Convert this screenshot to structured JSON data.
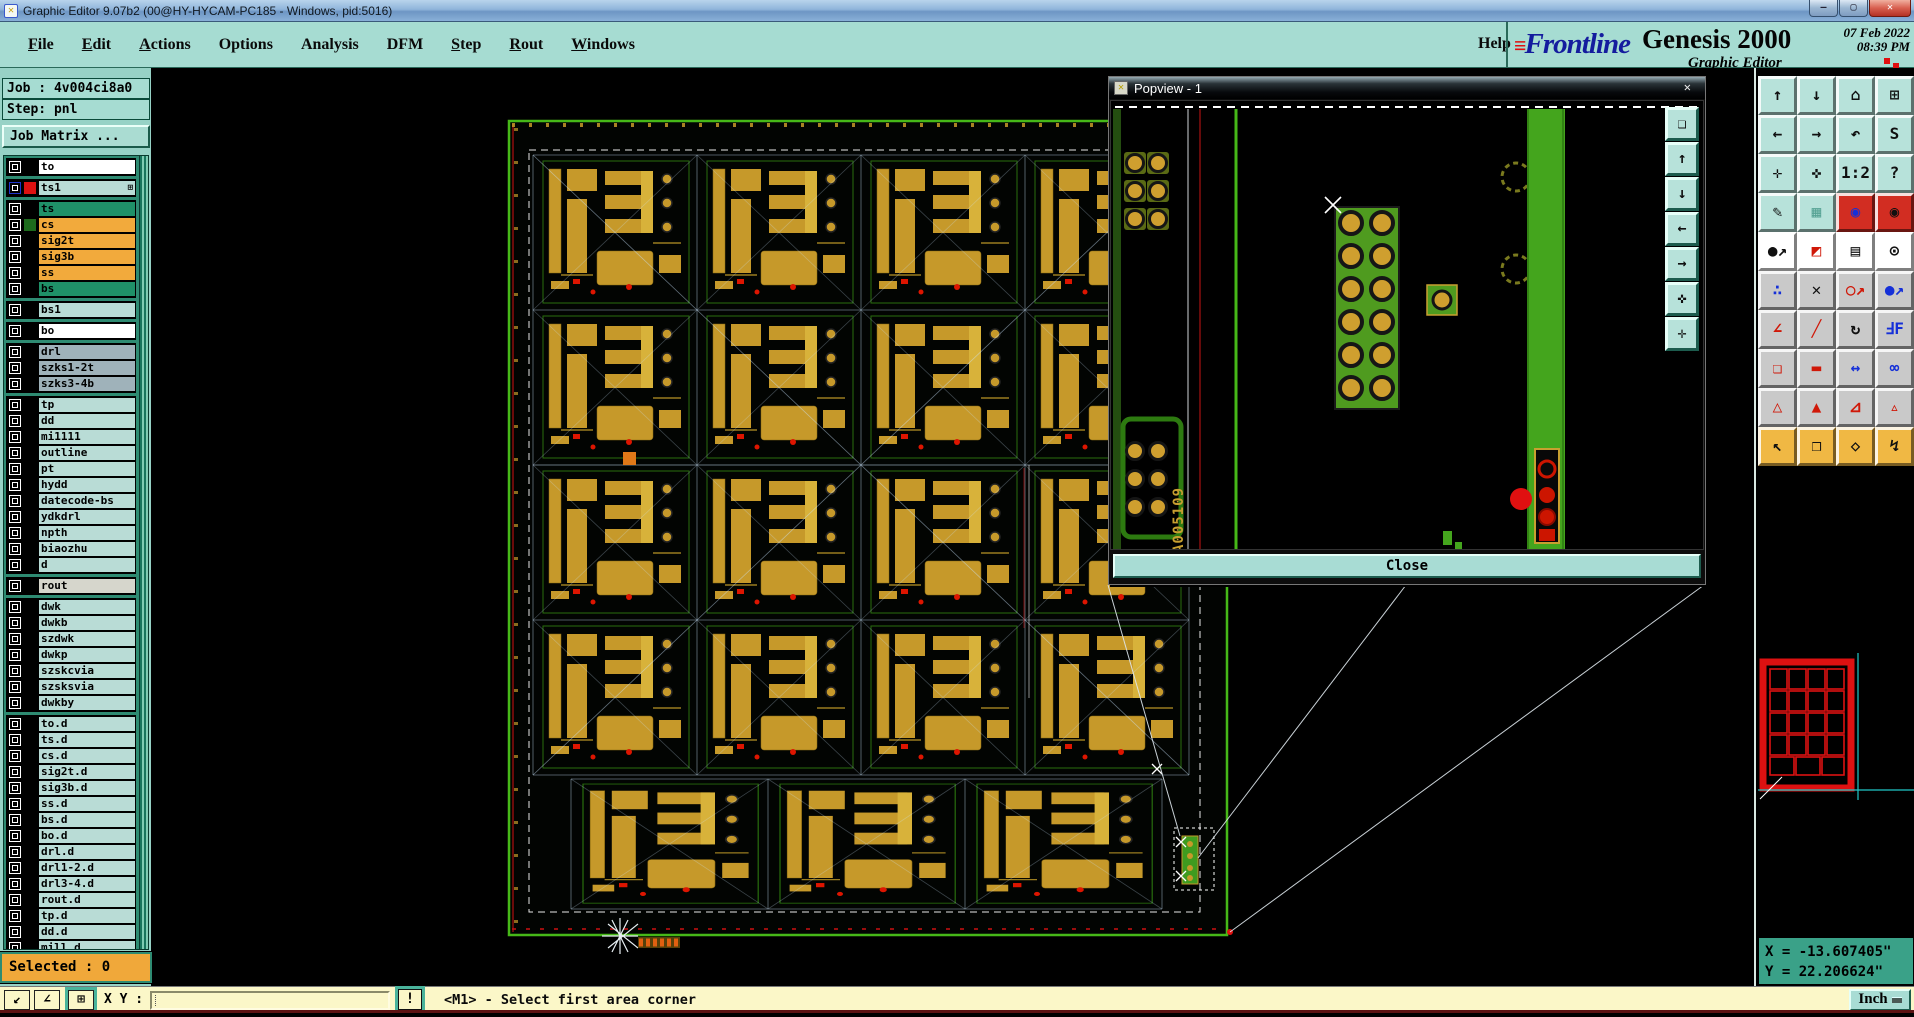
{
  "window": {
    "title": "Graphic Editor 9.07b2 (00@HY-HYCAM-PC185 - Windows, pid:5016)",
    "controls": [
      {
        "name": "minimize-button",
        "glyph": "—"
      },
      {
        "name": "restore-button",
        "glyph": "▢"
      },
      {
        "name": "close-button",
        "glyph": "✕",
        "cls": "winbtn close"
      }
    ]
  },
  "menubar": {
    "items": [
      {
        "label": "File",
        "u": "1"
      },
      {
        "label": "Edit",
        "u": "1"
      },
      {
        "label": "Actions",
        "u": "1"
      },
      {
        "label": "Options",
        "u": "0"
      },
      {
        "label": "Analysis",
        "u": "0"
      },
      {
        "label": "DFM",
        "u": "0"
      },
      {
        "label": "Step",
        "u": "1"
      },
      {
        "label": "Rout",
        "u": "1"
      },
      {
        "label": "Windows",
        "u": "1"
      }
    ],
    "help": "Help"
  },
  "brand": {
    "logo": "Frontline",
    "product": "Genesis 2000",
    "date": "07 Feb 2022",
    "time": "08:39 PM",
    "app": "Graphic Editor"
  },
  "job_panel": {
    "job": "Job : 4v004ci8a0",
    "step": "Step: pnl",
    "matrix": "Job Matrix ..."
  },
  "layers": {
    "g1": [
      {
        "name": "to",
        "bg": "#ffffff"
      }
    ],
    "g2": [
      {
        "name": "ts1",
        "bg": "#b9dcd6",
        "swatch": "#dd1111",
        "cb": "#2036cc",
        "badge": "⊞"
      }
    ],
    "g3": [
      {
        "name": "ts",
        "bg": "#1f9168"
      },
      {
        "name": "cs",
        "bg": "#f2aa3c",
        "swatch": "#1d6b1d"
      },
      {
        "name": "sig2t",
        "bg": "#f2aa3c"
      },
      {
        "name": "sig3b",
        "bg": "#f2aa3c"
      },
      {
        "name": "ss",
        "bg": "#f2aa3c"
      },
      {
        "name": "bs",
        "bg": "#1f9168"
      }
    ],
    "g4": [
      {
        "name": "bs1",
        "bg": "#b9dcd6"
      }
    ],
    "g5": [
      {
        "name": "bo",
        "bg": "#ffffff"
      }
    ],
    "g6": [
      {
        "name": "drl",
        "bg": "#9fb2ba"
      },
      {
        "name": "szks1-2t",
        "bg": "#9fb2ba"
      },
      {
        "name": "szks3-4b",
        "bg": "#9fb2ba"
      }
    ],
    "g7": [
      {
        "name": "tp",
        "bg": "#b9dcd6"
      },
      {
        "name": "dd",
        "bg": "#b9dcd6"
      },
      {
        "name": "mi1111",
        "bg": "#b9dcd6"
      },
      {
        "name": "outline",
        "bg": "#b9dcd6"
      },
      {
        "name": "pt",
        "bg": "#b9dcd6"
      },
      {
        "name": "hydd",
        "bg": "#b9dcd6"
      },
      {
        "name": "datecode-bs",
        "bg": "#b9dcd6"
      },
      {
        "name": "ydkdrl",
        "bg": "#b9dcd6"
      },
      {
        "name": "npth",
        "bg": "#b9dcd6"
      },
      {
        "name": "biaozhu",
        "bg": "#b9dcd6"
      },
      {
        "name": "d",
        "bg": "#b9dcd6"
      }
    ],
    "g8": [
      {
        "name": "rout",
        "bg": "#d6d6cc"
      }
    ],
    "g9": [
      {
        "name": "dwk",
        "bg": "#b9dcd6"
      },
      {
        "name": "dwkb",
        "bg": "#b9dcd6"
      },
      {
        "name": "szdwk",
        "bg": "#b9dcd6"
      },
      {
        "name": "dwkp",
        "bg": "#b9dcd6"
      },
      {
        "name": "szskcvia",
        "bg": "#b9dcd6"
      },
      {
        "name": "szsksvia",
        "bg": "#b9dcd6"
      },
      {
        "name": "dwkby",
        "bg": "#b9dcd6"
      }
    ],
    "g10": [
      {
        "name": "to.d",
        "bg": "#b9dcd6"
      },
      {
        "name": "ts.d",
        "bg": "#b9dcd6"
      },
      {
        "name": "cs.d",
        "bg": "#b9dcd6"
      },
      {
        "name": "sig2t.d",
        "bg": "#b9dcd6"
      },
      {
        "name": "sig3b.d",
        "bg": "#b9dcd6"
      },
      {
        "name": "ss.d",
        "bg": "#b9dcd6"
      },
      {
        "name": "bs.d",
        "bg": "#b9dcd6"
      },
      {
        "name": "bo.d",
        "bg": "#b9dcd6"
      },
      {
        "name": "drl.d",
        "bg": "#b9dcd6"
      },
      {
        "name": "drl1-2.d",
        "bg": "#b9dcd6"
      },
      {
        "name": "drl3-4.d",
        "bg": "#b9dcd6"
      },
      {
        "name": "rout.d",
        "bg": "#b9dcd6"
      },
      {
        "name": "tp.d",
        "bg": "#b9dcd6"
      },
      {
        "name": "dd.d",
        "bg": "#b9dcd6"
      },
      {
        "name": "mill.d",
        "bg": "#b9dcd6"
      }
    ]
  },
  "selected_bar": {
    "text": "Selected : 0"
  },
  "popview": {
    "title": "Popview - 1",
    "close_x": "✕",
    "close_label": "Close",
    "board_text": "A005109",
    "strip": [
      {
        "name": "capture-view-button",
        "glyph": "❏"
      },
      {
        "name": "pan-up-button",
        "glyph": "↑"
      },
      {
        "name": "pan-down-button",
        "glyph": "↓"
      },
      {
        "name": "pan-left-button",
        "glyph": "←"
      },
      {
        "name": "pan-right-button",
        "glyph": "→"
      },
      {
        "name": "center-view-button",
        "glyph": "✜"
      },
      {
        "name": "expand-view-button",
        "glyph": "✛"
      }
    ]
  },
  "right_toolbar": {
    "buttons": [
      {
        "name": "pan-up-button",
        "glyph": "↑",
        "bg": "#b7e2da",
        "fg": "#101010"
      },
      {
        "name": "pan-down-button",
        "glyph": "↓",
        "bg": "#b7e2da",
        "fg": "#101010"
      },
      {
        "name": "home-view-button",
        "glyph": "⌂",
        "bg": "#b7e2da",
        "fg": "#101010"
      },
      {
        "name": "split-xy-button",
        "glyph": "⊞",
        "bg": "#b7e2da",
        "fg": "#101010"
      },
      {
        "name": "pan-left-button",
        "glyph": "←",
        "bg": "#b7e2da",
        "fg": "#101010"
      },
      {
        "name": "pan-right-button",
        "glyph": "→",
        "bg": "#b7e2da",
        "fg": "#101010"
      },
      {
        "name": "previous-view-button",
        "glyph": "↶",
        "bg": "#b7e2da",
        "fg": "#101010"
      },
      {
        "name": "serpentine-view-button",
        "glyph": "S",
        "bg": "#b7e2da",
        "fg": "#101010"
      },
      {
        "name": "zoom-out-button",
        "glyph": "✛",
        "bg": "#b7e2da",
        "fg": "#101010"
      },
      {
        "name": "zoom-in-button",
        "glyph": "✜",
        "bg": "#b7e2da",
        "fg": "#101010"
      },
      {
        "name": "scale-1-2-button",
        "glyph": "1:2",
        "bg": "#b7e2da",
        "fg": "#101010"
      },
      {
        "name": "help-button",
        "glyph": "?",
        "bg": "#b7e2da",
        "fg": "#101010"
      },
      {
        "name": "graphic-options-button",
        "glyph": "✎",
        "bg": "#b7e2da",
        "fg": "#101010"
      },
      {
        "name": "grid-button",
        "glyph": "▦",
        "bg": "#b7e2da",
        "fg": "#56a294"
      },
      {
        "name": "layer-colors-button",
        "glyph": "◉",
        "bg": "#d22d22",
        "fg": "#1530d8"
      },
      {
        "name": "layer-status-button",
        "glyph": "◉",
        "bg": "#d22d22",
        "fg": "#101010"
      },
      {
        "name": "select-feature-button",
        "glyph": "●↗",
        "bg": "#ffffff",
        "fg": "#101010"
      },
      {
        "name": "measure-squares-button",
        "glyph": "◩",
        "bg": "#ffffff",
        "fg": "#d01808"
      },
      {
        "name": "ruler-button",
        "glyph": "▤",
        "bg": "#ffffff",
        "fg": "#101010"
      },
      {
        "name": "select-area-button",
        "glyph": "⊙",
        "bg": "#ffffff",
        "fg": "#101010"
      },
      {
        "name": "net-points-button",
        "glyph": "∴",
        "bg": "#c9c9c9",
        "fg": "#1530d8"
      },
      {
        "name": "delete-button",
        "glyph": "✕",
        "bg": "#c9c9c9",
        "fg": "#101010"
      },
      {
        "name": "copy-feature-button",
        "glyph": "○↗",
        "bg": "#c9c9c9",
        "fg": "#d01808"
      },
      {
        "name": "move-feature-button",
        "glyph": "●↗",
        "bg": "#c9c9c9",
        "fg": "#1530d8"
      },
      {
        "name": "angle-measure-button",
        "glyph": "∠",
        "bg": "#c9c9c9",
        "fg": "#d01808"
      },
      {
        "name": "slope-line-button",
        "glyph": "╱",
        "bg": "#c9c9c9",
        "fg": "#d01808"
      },
      {
        "name": "rotate-button",
        "glyph": "↻",
        "bg": "#c9c9c9",
        "fg": "#101010"
      },
      {
        "name": "mirror-button",
        "glyph": "ℲF",
        "bg": "#c9c9c9",
        "fg": "#1530d8"
      },
      {
        "name": "copy-to-layer-button",
        "glyph": "❏",
        "bg": "#c9c9c9",
        "fg": "#d01808"
      },
      {
        "name": "trace-segment-button",
        "glyph": "▬",
        "bg": "#c9c9c9",
        "fg": "#d01808"
      },
      {
        "name": "measure-width-button",
        "glyph": "↔",
        "bg": "#c9c9c9",
        "fg": "#1530d8"
      },
      {
        "name": "touching-copper-button",
        "glyph": "∞",
        "bg": "#c9c9c9",
        "fg": "#1530d8"
      },
      {
        "name": "triangle-tool-button",
        "glyph": "△",
        "bg": "#c9c9c9",
        "fg": "#d01808"
      },
      {
        "name": "triangle-tall-tool-button",
        "glyph": "▲",
        "bg": "#c9c9c9",
        "fg": "#d01808"
      },
      {
        "name": "triangle-trap-tool-button",
        "glyph": "⊿",
        "bg": "#c9c9c9",
        "fg": "#d01808"
      },
      {
        "name": "triangle-base-tool-button",
        "glyph": "▵",
        "bg": "#c9c9c9",
        "fg": "#d01808"
      },
      {
        "name": "select-single-button",
        "glyph": "↖",
        "bg": "#f0b844",
        "fg": "#101010"
      },
      {
        "name": "select-frame-button",
        "glyph": "❒",
        "bg": "#f0b844",
        "fg": "#101010"
      },
      {
        "name": "select-poly-button",
        "glyph": "◇",
        "bg": "#f0b844",
        "fg": "#101010"
      },
      {
        "name": "select-net-button",
        "glyph": "↯",
        "bg": "#f0b844",
        "fg": "#101010"
      }
    ]
  },
  "coords": {
    "x": "X = -13.607405\"",
    "y": "Y = 22.206624\""
  },
  "command_bar": {
    "icons": [
      {
        "name": "snap-corner-button",
        "glyph": "↙",
        "cls": "cmdbtn",
        "x": "4px"
      },
      {
        "name": "snap-angle-button",
        "glyph": "∠",
        "cls": "cmdbtn",
        "x": "34px"
      },
      {
        "name": "quadrant-mode-button",
        "glyph": "⊞",
        "cls": "cmdbtn framed",
        "x": "68px"
      }
    ],
    "xy_label": "X Y :",
    "input_value": "",
    "bang": "!",
    "status": "<M1> - Select first area corner",
    "units": "Inch"
  },
  "colors": {
    "ui_teal": "#a6dcd2",
    "panel_green": "#2e8b72",
    "selected_orange": "#f0a83a",
    "cream": "#fbf7c8",
    "pcb_green": "#44a51d",
    "pcb_gold": "#c6992a",
    "alert_red": "#dd1111",
    "coords_teal": "#3aa188"
  }
}
